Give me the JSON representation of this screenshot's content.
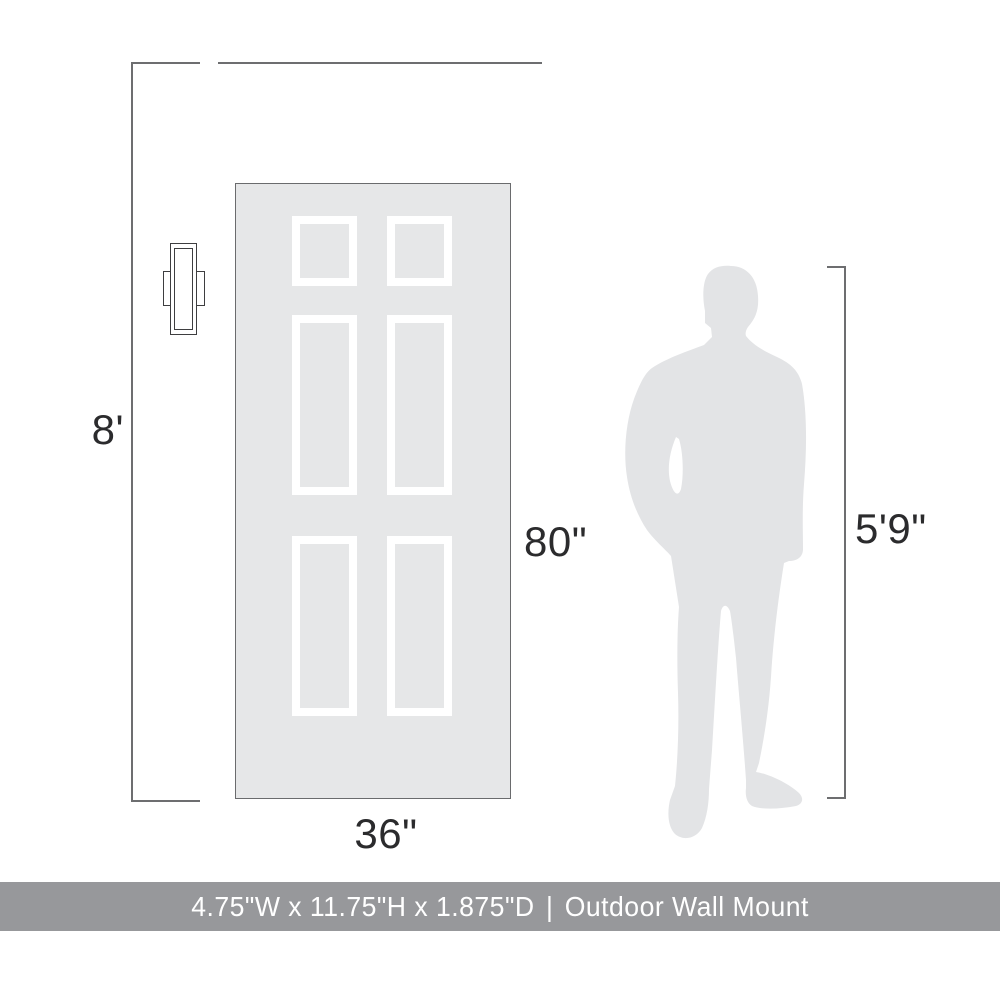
{
  "product_diagram": {
    "labels": {
      "wall_height": "8'",
      "door_height": "80\"",
      "door_width": "36\"",
      "person_height": "5'9\""
    },
    "footer": {
      "product_dimensions": "4.75\"W x 11.75\"H x 1.875\"D",
      "separator": "|",
      "category": "Outdoor Wall Mount"
    },
    "objects": {
      "door": "six-panel-door",
      "fixture": "outdoor-wall-sconce",
      "person": "male-silhouette-5ft9"
    },
    "colors": {
      "background": "#ffffff",
      "door_fill": "#e6e7e8",
      "door_border": "#6a6b6d",
      "panel_frame": "#ffffff",
      "silhouette_fill": "#e3e4e6",
      "dimension_line": "#6d6e70",
      "label_text": "#2b2b2d",
      "footer_background": "#97989b",
      "footer_text": "#ffffff"
    }
  }
}
